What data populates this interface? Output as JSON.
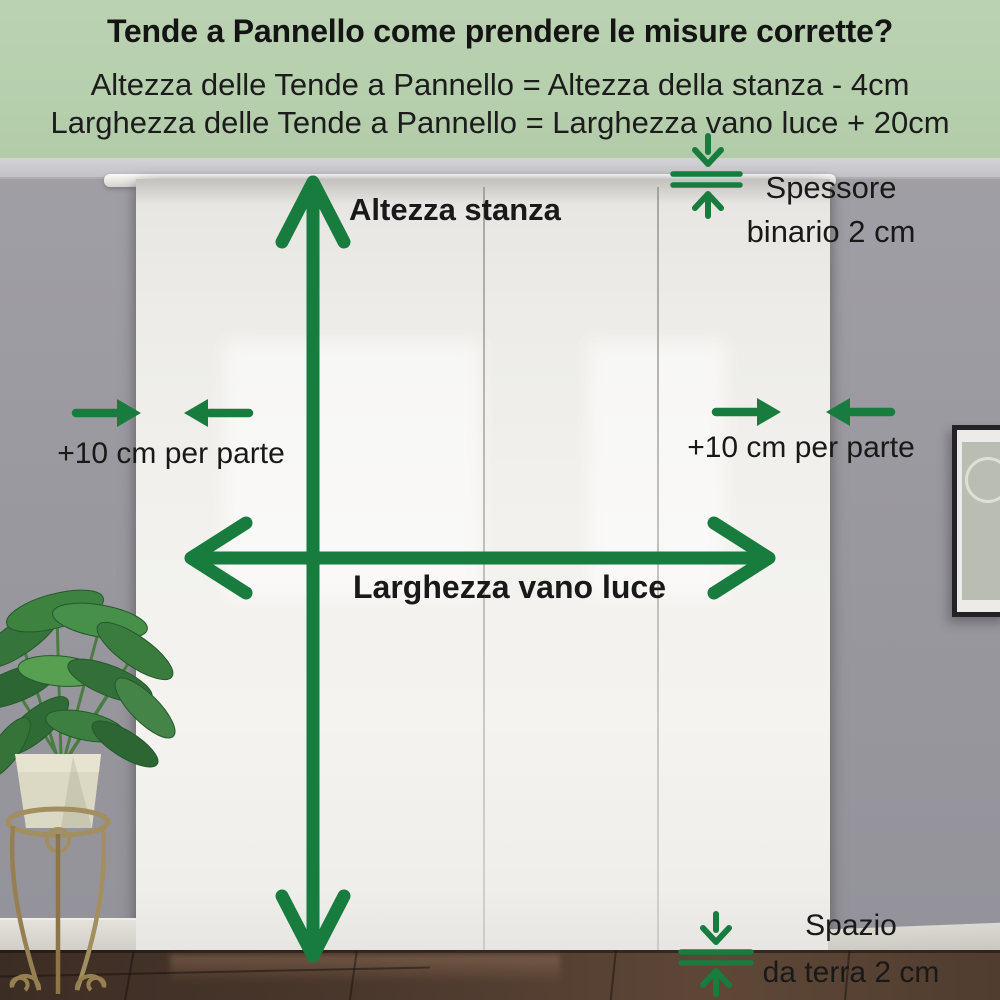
{
  "colors": {
    "accent_green": "#177C3E",
    "header_background": "#B6CFAD",
    "text": "#1A1A1A"
  },
  "header": {
    "title": "Tende a Pannello come prendere le misure corrette?",
    "formula_height": "Altezza delle Tende a Pannello = Altezza della stanza - 4cm",
    "formula_width": "Larghezza delle Tende a Pannello = Larghezza vano luce + 20cm"
  },
  "measurements": {
    "room_height": {
      "label": "Altezza stanza"
    },
    "opening_width": {
      "label": "Larghezza vano luce"
    },
    "left_margin": {
      "label": "+10 cm per parte"
    },
    "right_margin": {
      "label": "+10 cm per parte"
    },
    "rail_thickness": {
      "line1": "Spessore",
      "line2": "binario 2 cm"
    },
    "floor_gap": {
      "line1": "Spazio",
      "line2": "da terra 2 cm"
    }
  },
  "icons": {
    "room-height-arrow": "↕",
    "opening-width-arrow": "↔",
    "margin-arrow-right": "→",
    "margin-arrow-left": "←",
    "rail-thickness-indicator": "⇳",
    "floor-gap-indicator": "⇳"
  }
}
